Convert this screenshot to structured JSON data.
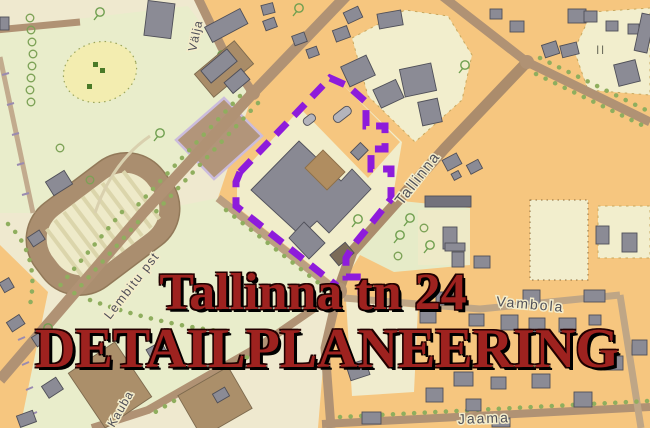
{
  "title": {
    "line1": "Tallinna tn 24",
    "line2": "DETAILPLANEERING"
  },
  "map": {
    "streets": [
      {
        "id": "valja",
        "name": "Välja"
      },
      {
        "id": "tallinna",
        "name": "Tallinna"
      },
      {
        "id": "lembitu",
        "name": "Lembitu pst"
      },
      {
        "id": "kauba",
        "name": "Kauba"
      },
      {
        "id": "vambola",
        "name": "Vambola"
      },
      {
        "id": "jaama",
        "name": "Jaama"
      }
    ],
    "markers": {
      "storey_marker_1": "II",
      "storey_marker_2": "II"
    },
    "colors": {
      "boundary_purple": "#8e1bdb",
      "title_red": "#9e221f",
      "block_orange": "#f6c67f",
      "block_cream": "#f3eecb",
      "park_green": "#e9edcb",
      "road_brown": "#b09274",
      "building_gray": "#8b8b95",
      "courtyard_brown": "#b08d60"
    }
  }
}
